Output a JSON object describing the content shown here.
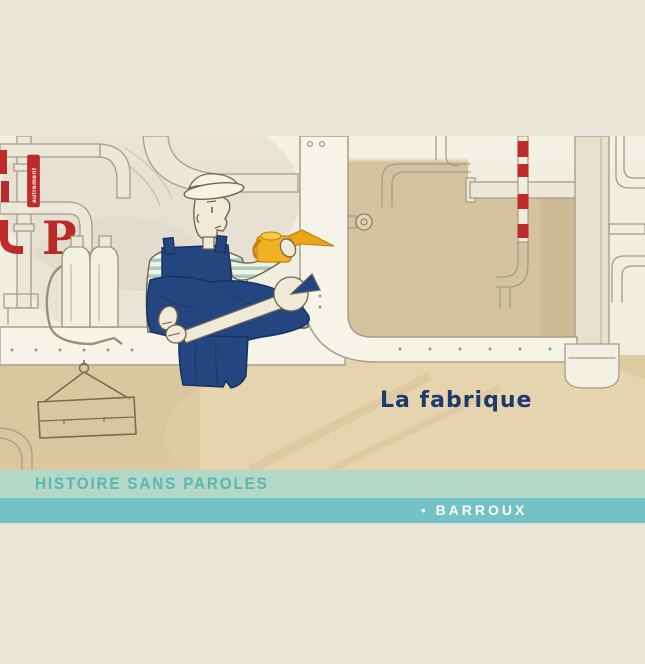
{
  "cover": {
    "title": "La fabrique",
    "series": "HISTOIRE SANS PAROLES",
    "author": "BARROUX",
    "author_bullet": "•",
    "publisher_logo": "autrement",
    "decorative_letter": "P",
    "colors": {
      "page_bg": "#e9e6d9",
      "series_band_bg": "#b3d8c5",
      "series_text": "#5cb6b2",
      "author_band_bg": "#74c2c6",
      "author_text": "#fdfdf3",
      "title_text": "#1c3a6e",
      "accent_red": "#bf2b2b",
      "overalls_navy": "#234580",
      "oilcan_yellow": "#f1b123",
      "wall": "#f0ede1",
      "tan_wall": "#d5c29e",
      "floor": "#decaa3"
    }
  }
}
